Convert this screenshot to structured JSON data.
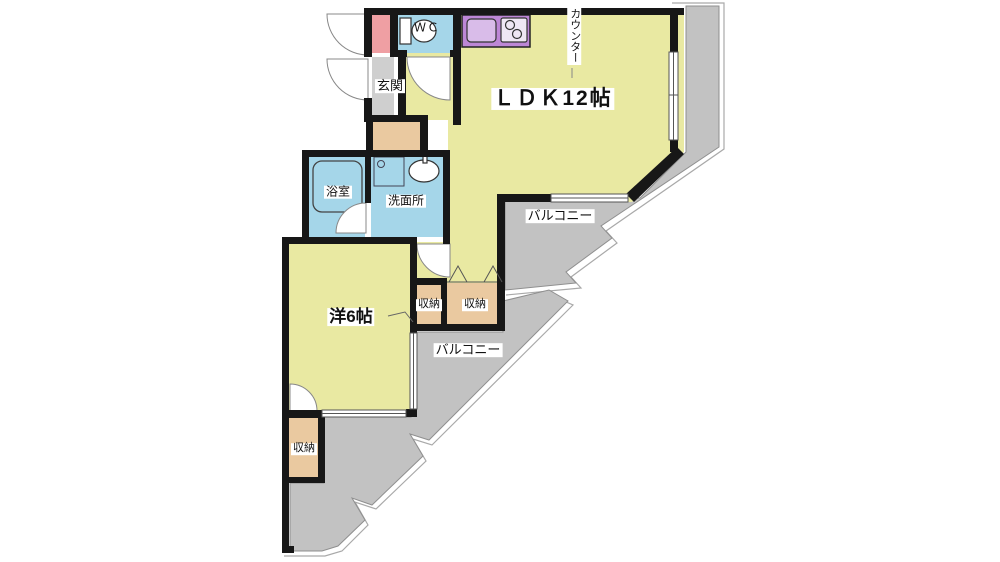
{
  "plan": {
    "labels": {
      "ldk": "ＬＤＫ12帖",
      "western_room": "洋6帖",
      "entrance": "玄関",
      "wc": "ＷＣ",
      "bath": "浴室",
      "washroom": "洗面所",
      "counter": "カウンター",
      "balcony_upper": "バルコニー",
      "balcony_lower": "バルコニー",
      "storage_left": "収納",
      "storage_right": "収納",
      "storage_bottom": "収納"
    },
    "colors": {
      "room_yellow": "#e9e9a2",
      "balcony_gray": "#c2c2c2",
      "wet_area_blue": "#a5d6e9",
      "entrance_gray": "#cfcfcf",
      "storage_tan": "#eac9a0",
      "shoe_cabinet_pink": "#ef9fa3",
      "kitchen_purple": "#bd87d6",
      "wall_black": "#171717"
    }
  }
}
